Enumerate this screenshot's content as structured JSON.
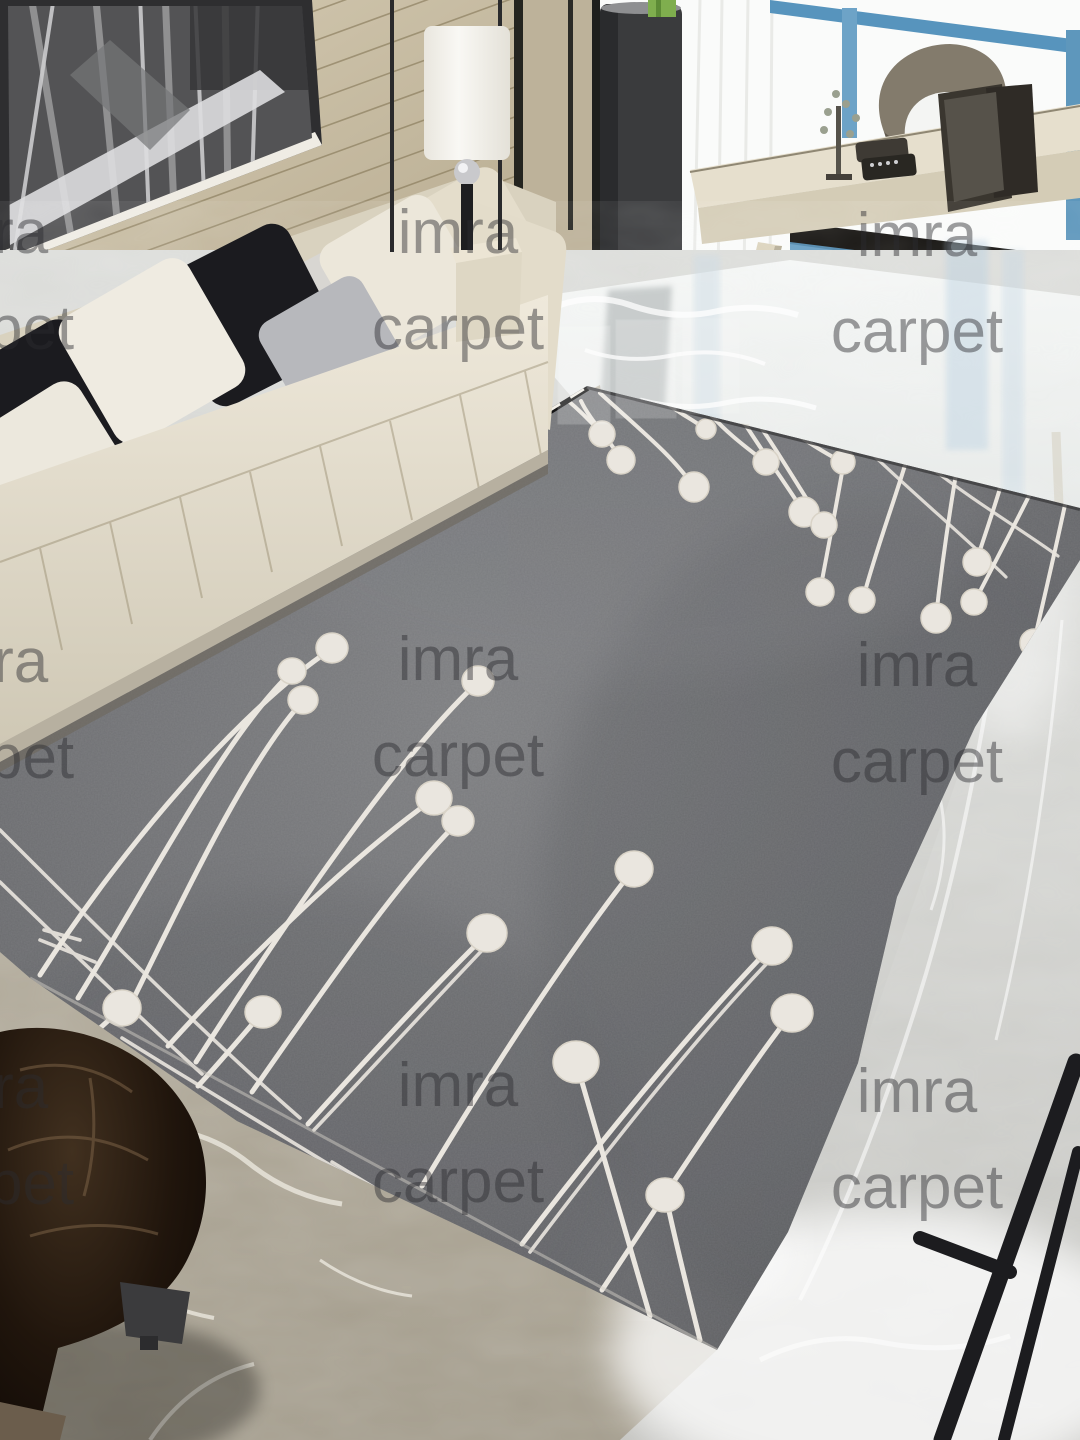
{
  "watermark": {
    "line1": "imra",
    "line2": "carpet",
    "font_size_px": 62,
    "line_height_px": 96,
    "color": "rgba(44,44,47,0.46)",
    "tiles": [
      {
        "cx": -12,
        "cy": 281
      },
      {
        "cx": 458,
        "cy": 281
      },
      {
        "cx": 917,
        "cy": 284
      },
      {
        "cx": -12,
        "cy": 710
      },
      {
        "cx": 458,
        "cy": 708
      },
      {
        "cx": 917,
        "cy": 714
      },
      {
        "cx": -12,
        "cy": 1136
      },
      {
        "cx": 458,
        "cy": 1134
      },
      {
        "cx": 917,
        "cy": 1140
      }
    ]
  },
  "colors": {
    "watermark": "rgba(44,44,47,0.46)",
    "wall-light": "#d2c8b0",
    "wall-dark": "#b3a88e",
    "art-bg": "#4a4a4c",
    "frame": "#2e2e30",
    "lamp-shade": "#f6f4ee",
    "pillar": "#3a3b3d",
    "window-white": "#fafbfa",
    "window-blue": "#5794bd",
    "table-top": "#e6dfcd",
    "table-face": "#d4ccb6",
    "chair-gray": "#837b6c",
    "sofa-cream": "#e7e1d3",
    "pillow-black": "#1b1b1f",
    "pillow-silver": "#b7b8bc",
    "pillow-light": "#d8d6d2",
    "pillow-cream": "#ece7da",
    "floor-right": "#eef0ee",
    "floor-center": "#d3d4d1",
    "floor-left": "#b5ae9e",
    "rug-light": "#7d7e80",
    "rug-dark": "#595a5d",
    "rug-pattern": "#eae6df",
    "binding": "#141414",
    "ottoman": "#1a110a"
  },
  "scene": {
    "objects": [
      "framed-artwork",
      "wood-panel-wall",
      "floor-lamp",
      "sliding-door-frame",
      "speaker-pillar",
      "green-vase",
      "window-wall",
      "console-desk",
      "desk-chair",
      "desk-decor",
      "tufted-sofa",
      "sofa-pillows",
      "side-table",
      "marble-floor",
      "gray-stem-rug",
      "leather-ottoman",
      "black-chair-legs"
    ]
  }
}
